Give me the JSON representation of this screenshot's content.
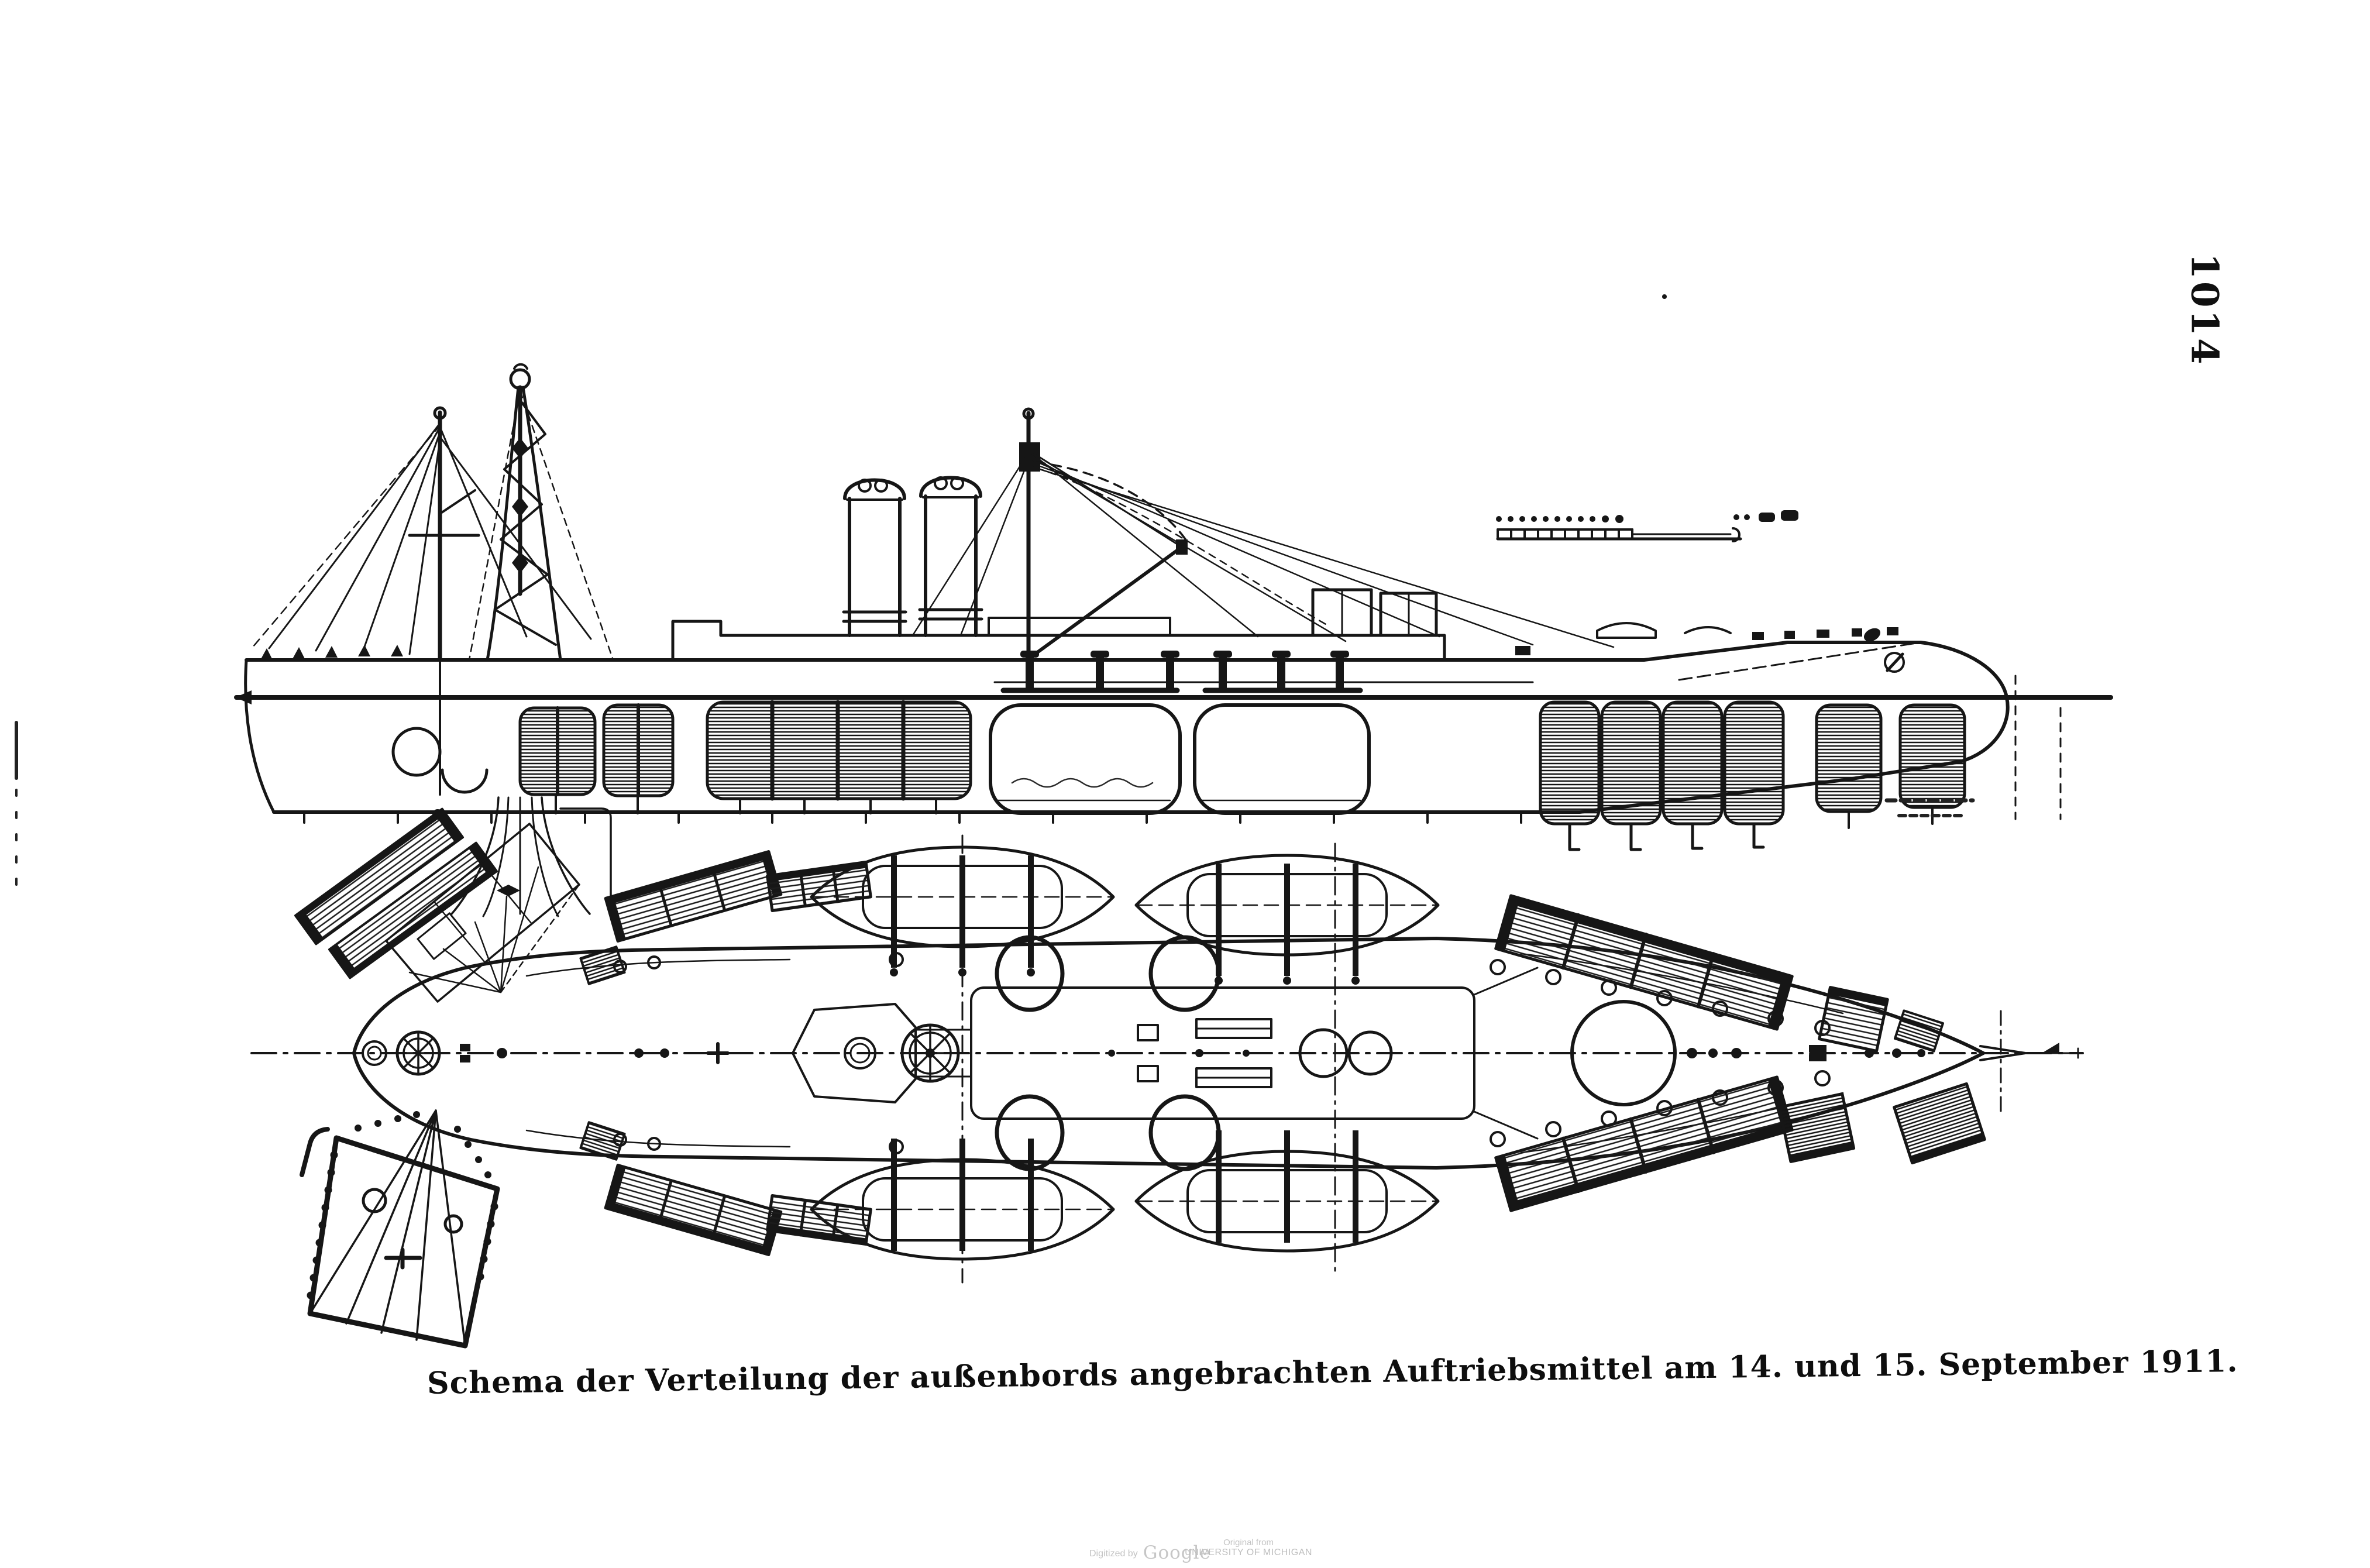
{
  "page": {
    "number": "1014",
    "paper_color": "#ffffff",
    "ink_color": "#161616"
  },
  "caption": {
    "text": "Schema der Verteilung der außenbords angebrachten Auftriebsmittel am 14. und 15. September 1911."
  },
  "watermark": {
    "digitized_by": "Digitized by",
    "brand": "Google",
    "original_from": "Original from",
    "institution": "UNIVERSITY OF MICHIGAN",
    "color": "#c3c3c3"
  }
}
